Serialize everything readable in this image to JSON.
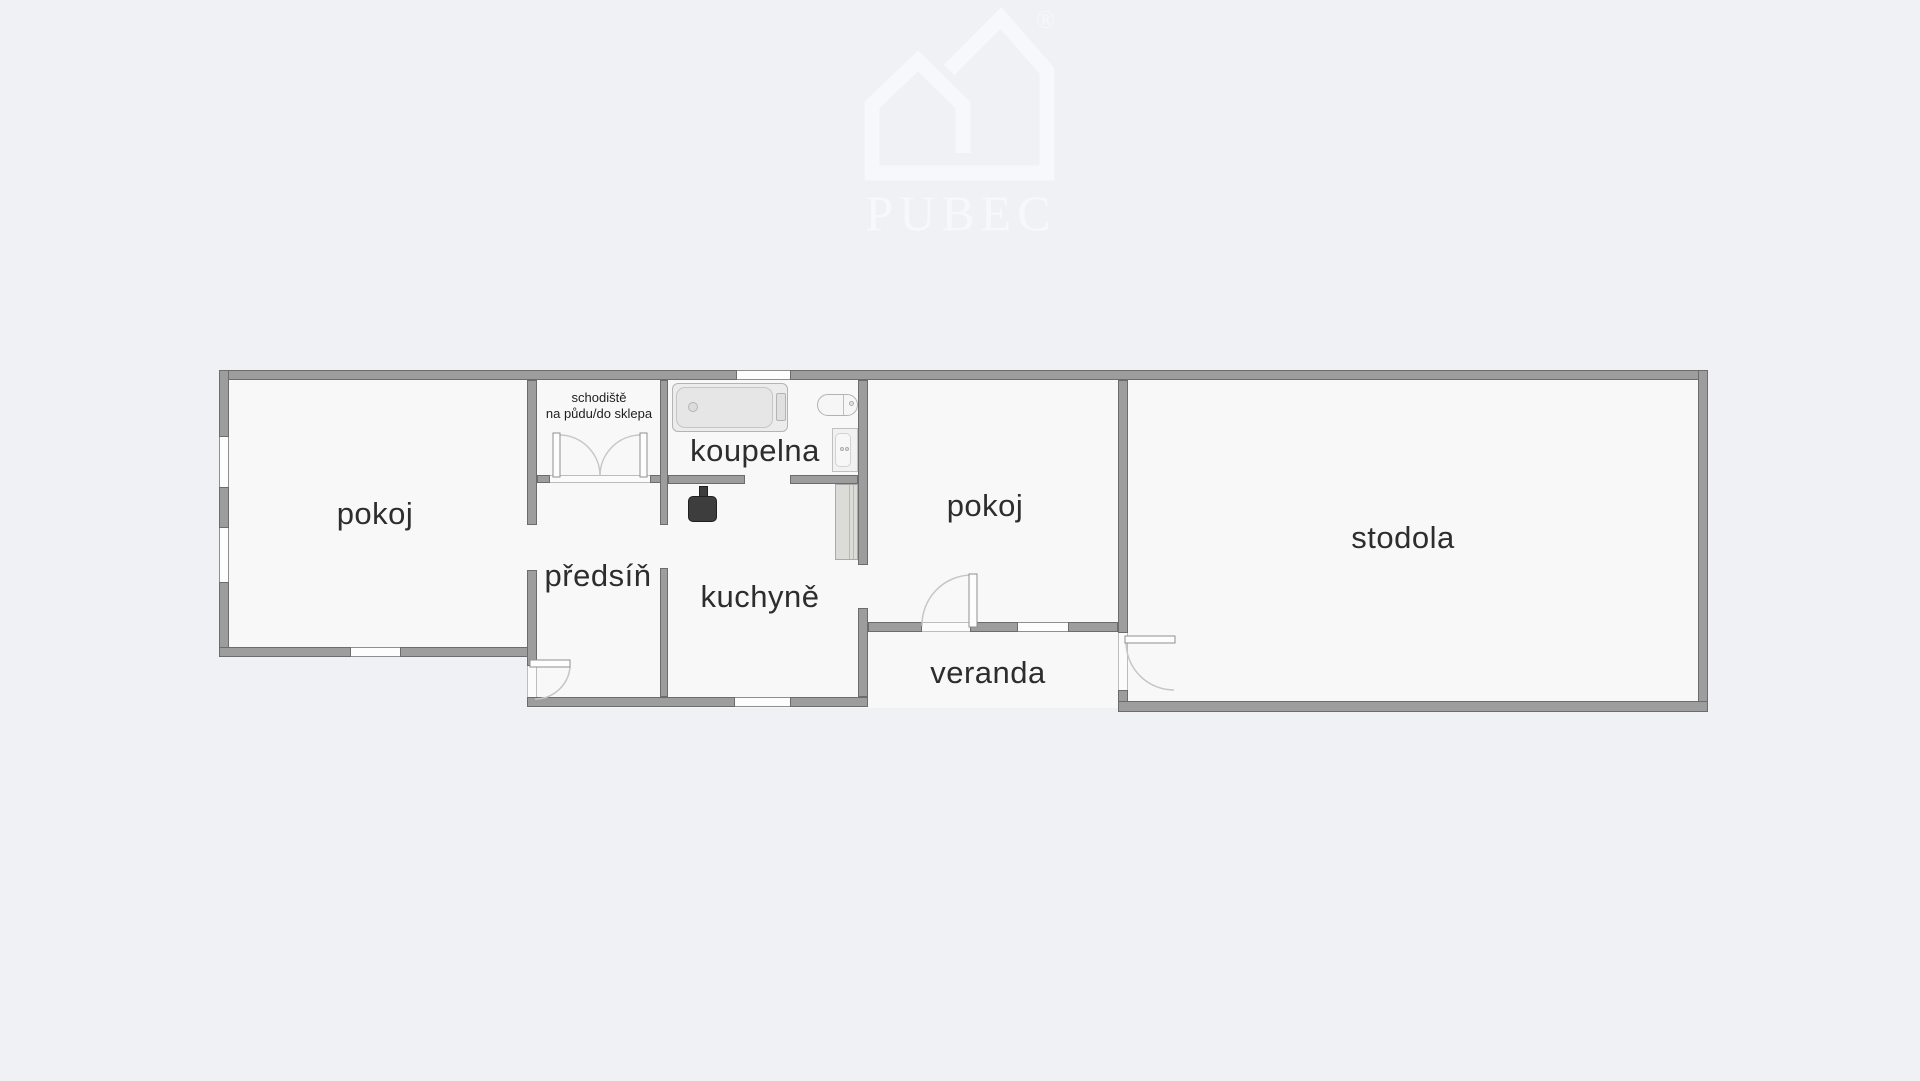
{
  "watermark": {
    "brand": "PUBEC",
    "registered": "®"
  },
  "rooms": {
    "pokoj_left": "pokoj",
    "schodiste_line1": "schodiště",
    "schodiste_line2": "na půdu/do sklepa",
    "koupelna": "koupelna",
    "predsin": "předsíň",
    "kuchyne": "kuchyně",
    "pokoj_right": "pokoj",
    "veranda": "veranda",
    "stodola": "stodola"
  },
  "fixtures": [
    "bathtub",
    "toilet",
    "washbasin",
    "stove",
    "cabinet"
  ],
  "doors": [
    "double-door-staircase",
    "entrance-door-hall",
    "door-room-to-veranda",
    "door-veranda-to-barn"
  ],
  "colors": {
    "background": "#eff1f5",
    "floor": "#f8f8f9",
    "wall_fill": "#9d9d9d",
    "wall_outline": "#6c6c6c",
    "label_text": "#2d2d2d",
    "door_arc": "#c6c6c6",
    "fixture_dark": "#3d3d3d",
    "watermark": "#f7f8fb"
  }
}
